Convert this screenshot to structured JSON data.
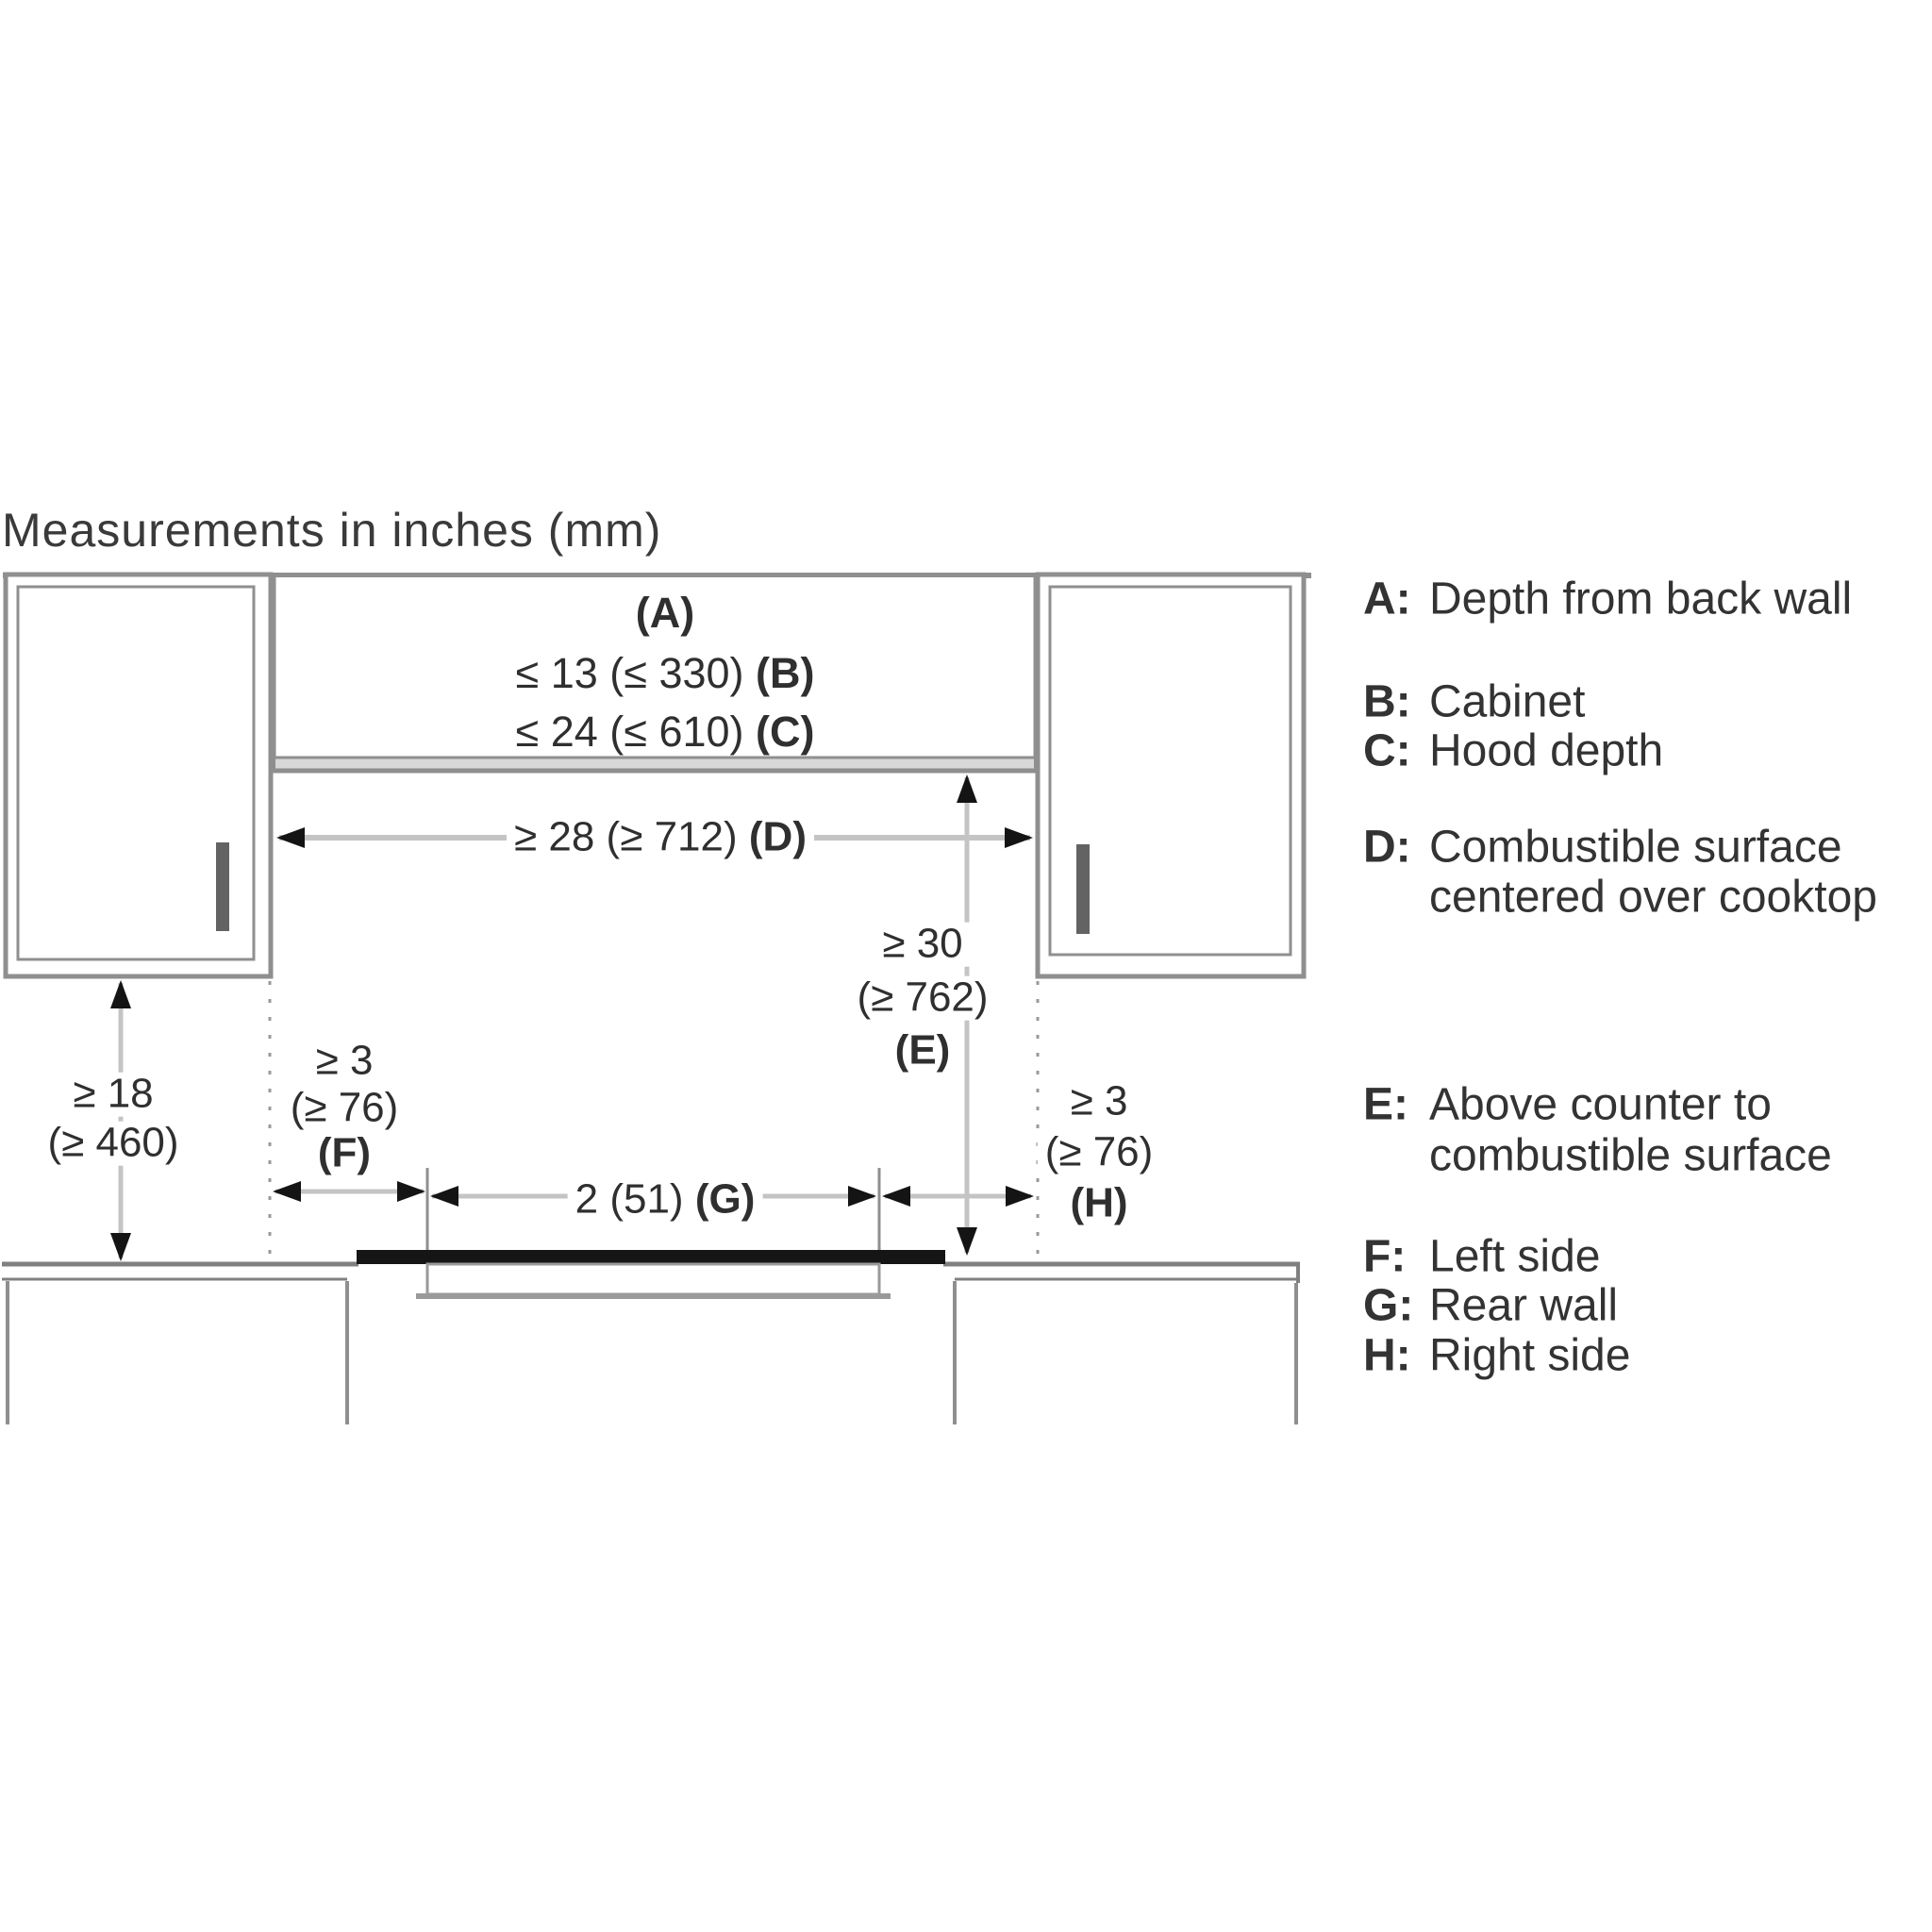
{
  "title": "Measurements in inches (mm)",
  "colors": {
    "structure_line": "#8f8f8f",
    "dimension_line": "#c4c4c4",
    "arrowhead": "#141414",
    "cooktop_bar": "#151515",
    "hood_band": "#d8d8d8",
    "text": "#2f2f2f"
  },
  "dimensions": {
    "a": {
      "label": "(A)"
    },
    "b": {
      "value": "≤ 13 (≤ 330)",
      "label": "(B)"
    },
    "c": {
      "value": "≤ 24 (≤ 610)",
      "label": "(C)"
    },
    "d": {
      "value": "≥ 28 (≥ 712)",
      "label": "(D)"
    },
    "e": {
      "line1": "≥ 30",
      "line2": "(≥ 762)",
      "label": "(E)"
    },
    "clearance_18": {
      "line1": "≥ 18",
      "line2": "(≥ 460)"
    },
    "f": {
      "line1": "≥ 3",
      "line2": "(≥ 76)",
      "label": "(F)"
    },
    "g": {
      "value": "2 (51)",
      "label": "(G)"
    },
    "h": {
      "line1": "≥ 3",
      "line2": "(≥ 76)",
      "label": "(H)"
    }
  },
  "legend": {
    "lines": [
      {
        "letter": "A:",
        "text": "Depth from back wall"
      },
      {
        "letter": "B:",
        "text": "Cabinet"
      },
      {
        "letter": "C:",
        "text": "Hood depth"
      },
      {
        "letter": "D:",
        "text": "Combustible surface"
      },
      {
        "letter": "",
        "text": "centered over cooktop"
      },
      {
        "letter": "E:",
        "text": "Above counter to"
      },
      {
        "letter": "",
        "text": "combustible surface"
      },
      {
        "letter": "F:",
        "text": "Left side"
      },
      {
        "letter": "G:",
        "text": "Rear wall"
      },
      {
        "letter": "H:",
        "text": "Right side"
      }
    ]
  }
}
